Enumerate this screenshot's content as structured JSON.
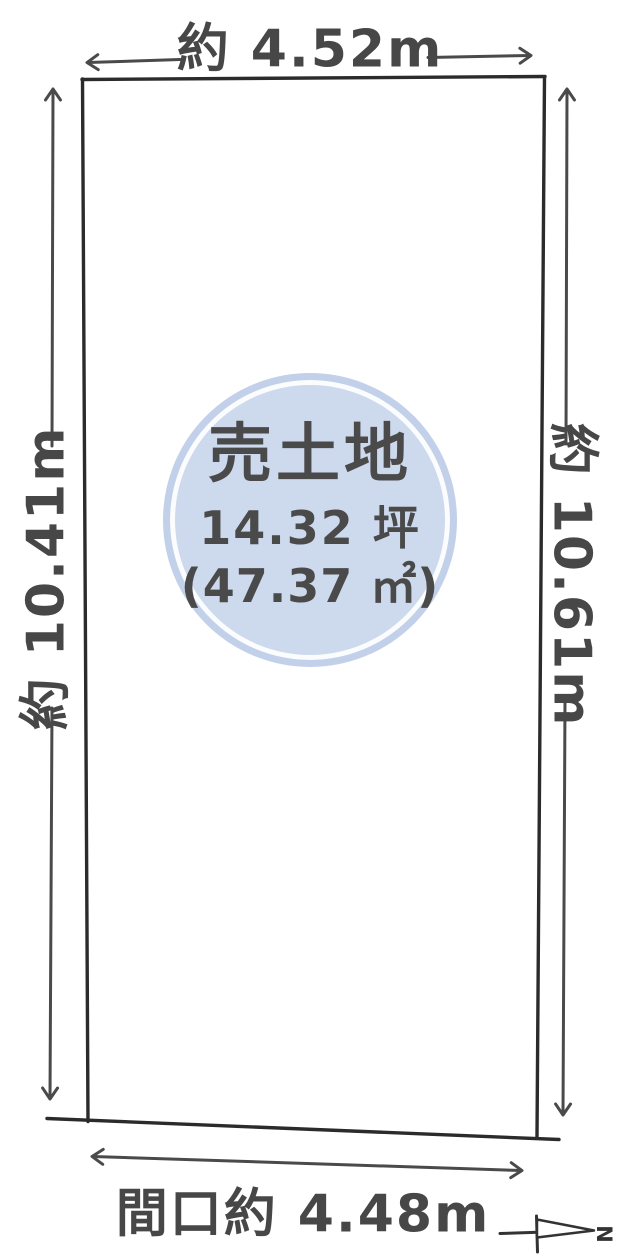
{
  "diagram": {
    "type": "land-plot-floorplan",
    "badge": {
      "title": "売土地",
      "area_tsubo": "14.32 坪",
      "area_sqm": "(47.37 ㎡)"
    },
    "dimensions": {
      "top": {
        "label": "約 4.52m"
      },
      "left": {
        "label": "約 10.41m"
      },
      "right": {
        "label": "約 10.61m"
      },
      "bottom": {
        "label": "間口約 4.48m"
      }
    },
    "compass": {
      "north_label": "N",
      "direction": "right"
    },
    "colors": {
      "background": "#ffffff",
      "outline": "#2b2b2b",
      "dimension_lines": "#4a4a4a",
      "text": "#474747",
      "badge_fill": "#cdd9ed",
      "badge_ring": "#c2d1e9",
      "badge_gap": "#f4f7fb"
    }
  }
}
